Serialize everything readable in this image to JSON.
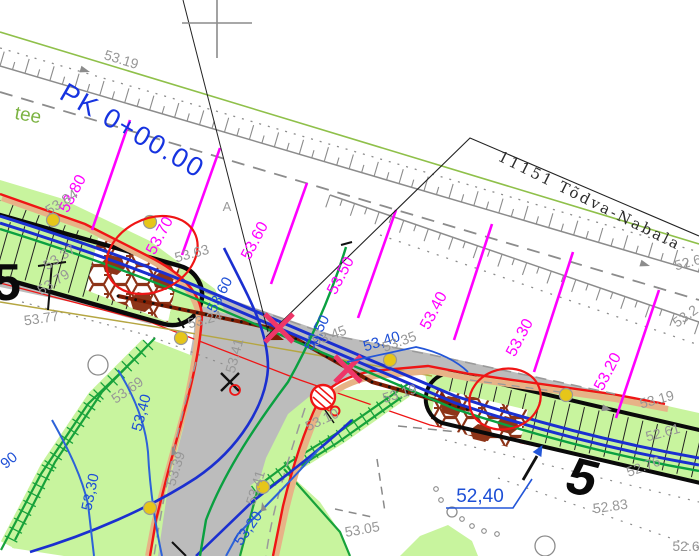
{
  "plan": {
    "station_label": "PK 0+00.00",
    "road_name": "11151 Tõdva-Nabala",
    "local_road_label": "tee",
    "zone_letter": "A",
    "detail_marker_left": "5",
    "detail_marker_right": "5"
  },
  "cross_sections": [
    "53.80",
    "53.70",
    "53.60",
    "53.50",
    "53.40",
    "53.30",
    "53.20"
  ],
  "design_edge_levels": [
    "53,60",
    "53,50",
    "53,40"
  ],
  "design_spot_level": "52,40",
  "design_contours": [
    "53,40",
    "53,30",
    "53,20",
    "90"
  ],
  "spots": [
    "53.19",
    "53.84",
    "53.37",
    "53.79",
    "53.77",
    "53.63",
    "53.24",
    "53.41",
    "53.45",
    "53.35",
    "53.19",
    "53.10",
    "53.69",
    "53.39",
    "53.41",
    "53.05",
    "53.19",
    "52.61",
    "52.76",
    "52.83",
    "52.6",
    "53.2",
    "52.6"
  ],
  "colors": {
    "section_magenta": "#ff00ff",
    "design_blue_text": "#1d4fd6",
    "utility_blue": "#1b2fd0",
    "contour_blue": "#2d62d8",
    "existing_gray": "#8c8c8c",
    "spot_text_gray": "#979797",
    "axis_dark_red": "#7e1e04",
    "curb_red": "#ef1515",
    "marker_crimson": "#ee3668",
    "grass_green_fill": "#c8f49e",
    "slope_green": "#17a23b",
    "design_green": "#0aa040",
    "boundary_green": "#8fc04a",
    "asphalt_gray": "#bcbcbc",
    "paver_brown": "#8d3418",
    "curb_tan": "#e7b387",
    "survey_yellow": "#e6c619"
  }
}
